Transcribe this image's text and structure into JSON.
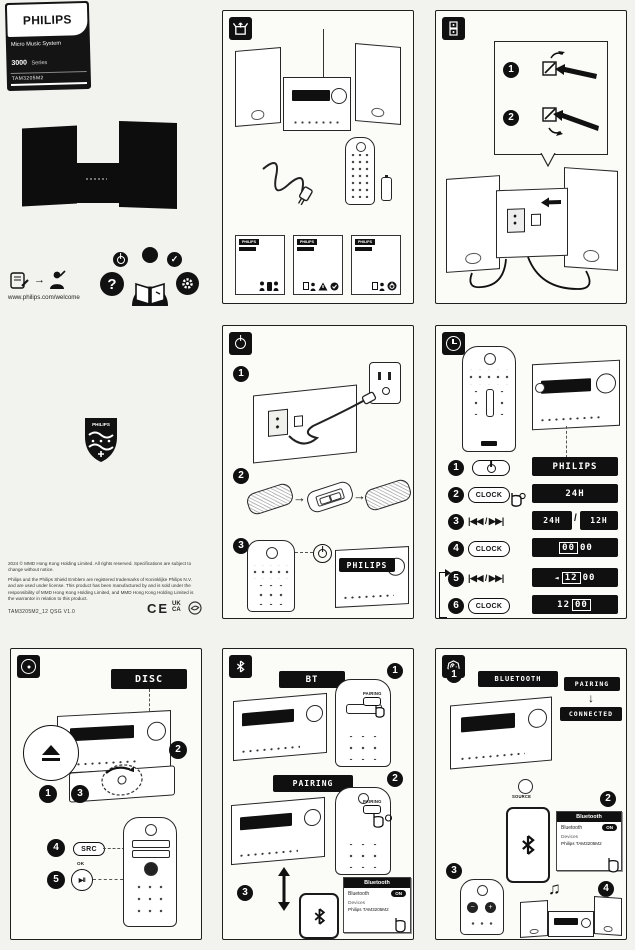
{
  "branding": {
    "logo": "PHILIPS",
    "product_name": "Micro Music System",
    "series": "3000",
    "series_suffix": "Series",
    "model": "TAM3205M2",
    "website": "www.philips.com/welcome"
  },
  "help": {
    "question": "?",
    "check": "✓"
  },
  "shield_logo": "PHILIPS",
  "leaflet_logo": "PHILIPS",
  "legal": {
    "copyright": "2024 © MMD Hong Kong Holding Limited. All rights reserved. Specifications are subject to change without notice.",
    "trademark": "Philips and the Philips Shield Emblem are registered trademarks of Koninklijke Philips N.V. and are used under license. This product has been manufactured by and is sold under the responsibility of MMD Hong Kong Holding Limited, and MMD Hong Kong Holding Limited is the warrantor in relation to this product.",
    "qsg_code": "TAM3205M2_12 QSG V1.0",
    "mark_ce": "CE",
    "mark_uk": "UK",
    "mark_ca": "CA"
  },
  "steps": {
    "s1": "1",
    "s2": "2",
    "s3": "3",
    "s4": "4",
    "s5": "5",
    "s6": "6"
  },
  "buttons": {
    "clock": "CLOCK",
    "skip": "|◀◀ / ▶▶|",
    "src": "SRC",
    "ok": "OK",
    "play_pause": "▶II",
    "source": "SOURCE",
    "pairing": "PAIRING",
    "vol_down": "−",
    "vol_up": "+"
  },
  "displays": {
    "philips": "PHILIPS",
    "h24": "24H",
    "h12": "12H",
    "slash": "/",
    "hh": "00",
    "mm": "00",
    "hh_set": "12",
    "select_arrow": "◄",
    "disc": "DISC",
    "bt": "BT",
    "pairing": "PAIRING",
    "bluetooth": "BLUETOOTH",
    "connected": "CONNECTED"
  },
  "phone": {
    "title": "Bluetooth",
    "bluetooth_label": "Bluetooth",
    "toggle_on": "ON",
    "devices_label": "Devices",
    "device_name": "Philips TAM3205M2"
  },
  "glyphs": {
    "arrow_right": "→",
    "down_arrow": "↓",
    "updown_arrow": "↕",
    "music_note": "♫",
    "warning": "!"
  }
}
